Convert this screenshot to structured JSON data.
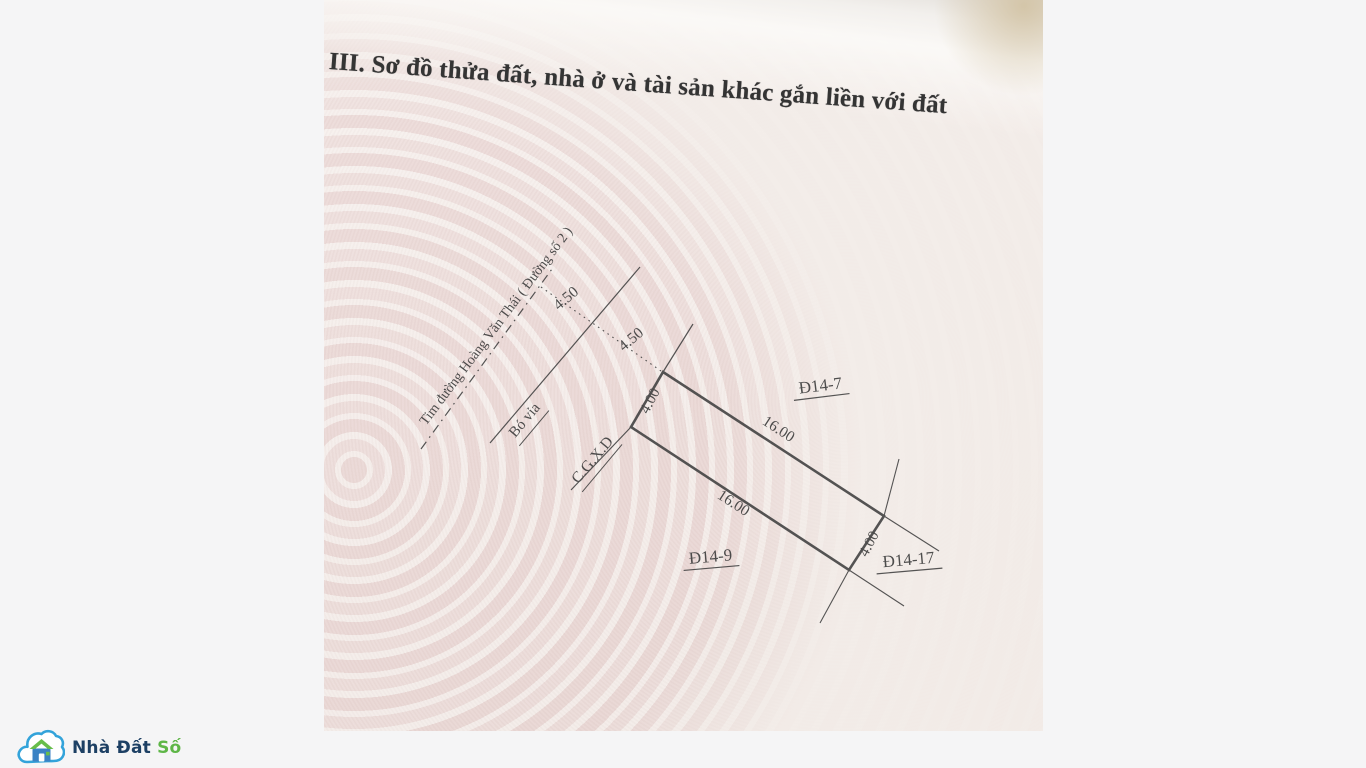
{
  "page": {
    "background_color": "#f5f5f6"
  },
  "document": {
    "section_title": "III. Sơ đồ thửa đất, nhà ở và tài sản khác gắn liền với đất",
    "diagram": {
      "road_label": "Tim đường Hoàng Văn Thái ( Đường số 2 )",
      "curb_label": "Bó vỉa",
      "setback_label": "C.G.X.D",
      "dimensions": {
        "centerline_to_curb": "4.50",
        "curb_to_boundary": "4.50",
        "frontage_left": "4.00",
        "depth_top": "16.00",
        "depth_bottom": "16.00",
        "frontage_right": "4.00"
      },
      "parcels": {
        "adjacent_top": "Đ14-7",
        "adjacent_bottom": "Đ14-9",
        "adjacent_right": "Đ14-17"
      },
      "ink_color": "#434343",
      "paper_tint": "#f2eae6"
    }
  },
  "watermark": {
    "brand_name_dark": "Nhà Đất",
    "brand_name_green": "Số",
    "colors": {
      "cloud_outline": "#33a3da",
      "house_roof": "#67bd4a",
      "house_body": "#3b82c4",
      "text_dark": "#1d4064",
      "text_green": "#5eb647"
    }
  }
}
